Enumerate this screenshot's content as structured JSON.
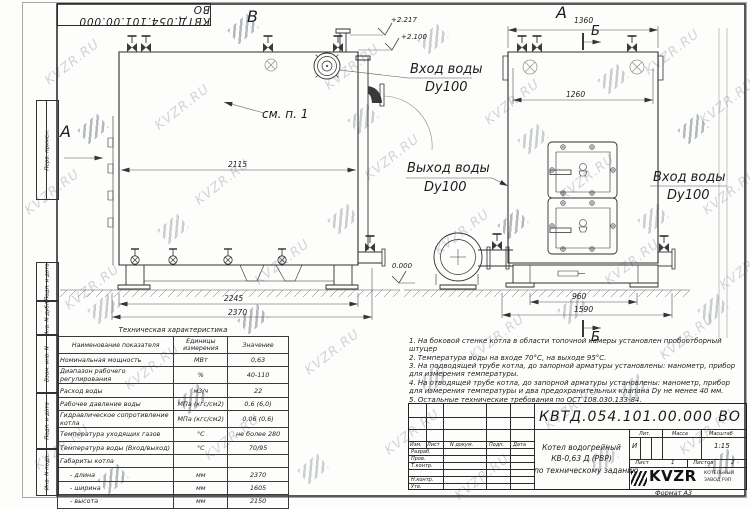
{
  "watermark": {
    "text": "KVZR.RU"
  },
  "stamp_vertical": {
    "labels": [
      "Перв. примен.",
      "Подп. и дата",
      "Инв. N дубл.",
      "Взам. инв. N",
      "Подп. и дата",
      "Инв. N подл."
    ]
  },
  "views": {
    "left": {
      "label": "В",
      "arrow_label": "А",
      "see_note": "см. п. 1",
      "dim_2115": "2115",
      "dim_2245": "2245",
      "dim_2370": "2370",
      "elev_2217": "+2.217",
      "elev_2100": "+2.100",
      "elev_0": "0.000"
    },
    "right": {
      "label": "А",
      "section_top": "Б",
      "section_bottom": "Б",
      "dim_1360": "1360",
      "dim_1260": "1260",
      "dim_960": "960",
      "dim_1590": "1590"
    }
  },
  "callouts": {
    "inlet_side": {
      "l1": "Вход воды",
      "l2": "Dy100"
    },
    "outlet": {
      "l1": "Выход воды",
      "l2": "Dy100"
    },
    "inlet_front": {
      "l1": "Вход воды",
      "l2": "Dy100"
    }
  },
  "tech_table": {
    "title": "Техническая характеристика",
    "headers": [
      "Наименование показателя",
      "Единицы измерения",
      "Значение"
    ],
    "rows": [
      [
        "Номинальная мощность",
        "МВт",
        "0,63"
      ],
      [
        "Диапазон рабочего регулирования",
        "%",
        "40-110"
      ],
      [
        "Расход воды",
        "м3/ч",
        "22"
      ],
      [
        "Рабочее давление воды",
        "МПа (кгс/см2)",
        "0,6 (6,0)"
      ],
      [
        "Гидравлическое сопротивление котла",
        "МПа (кгс/см2)",
        "0,06 (0,6)"
      ],
      [
        "Температура уходящих газов",
        "°С",
        "не более 280"
      ],
      [
        "Температура воды (Вход/выход)",
        "°С",
        "70/95"
      ],
      [
        "Габариты котла",
        "",
        ""
      ],
      [
        "- длина",
        "мм",
        "2370"
      ],
      [
        "- ширина",
        "мм",
        "1605"
      ],
      [
        "- высота",
        "мм",
        "2150"
      ]
    ]
  },
  "notes": [
    "1.  На боковой стенке котла в области топочной камеры установлен пробоотборный штуцер",
    "2.  Температура воды на входе  70°С,  на выходе  95°С.",
    "3.  На подводящей трубе котла, до запорной арматуры установлены:  манометр, прибор для измерения температуры.",
    "4.  На отводящей трубе котла, до запорной арматуры установлены:  манометр, прибор для измерения температуры и два предохранительных клапана  Dу не менее  40 мм.",
    "5.  Остальные технические требования по ОСТ  108.030.133-84."
  ],
  "title_block": {
    "designation": "КВТД.054.101.00.000  ВО",
    "cols": [
      "Изм.",
      "Лист",
      "N докум.",
      "Подп.",
      "Дата"
    ],
    "sig_rows": [
      "Разраб.",
      "Пров.",
      "Т.контр.",
      "Н.контр.",
      "Утв."
    ],
    "name_lines": [
      "Котел водогрейный",
      "КВ-0,63 Д (РВР)",
      "по техническому заданию"
    ],
    "lit_header": "Лит.",
    "mass_header": "Масса",
    "scale_header": "Масштаб",
    "lit_value": "И",
    "scale_value": "1:15",
    "sheet_label": "Лист",
    "sheet_value": "1",
    "sheets_label": "Листов",
    "sheets_value": "2",
    "logo": {
      "text": "KVZR",
      "sub1": "КОТЕЛЬНЫЙ",
      "sub2": "ЗАВОД РЭП"
    },
    "format": "Формат  А3"
  }
}
